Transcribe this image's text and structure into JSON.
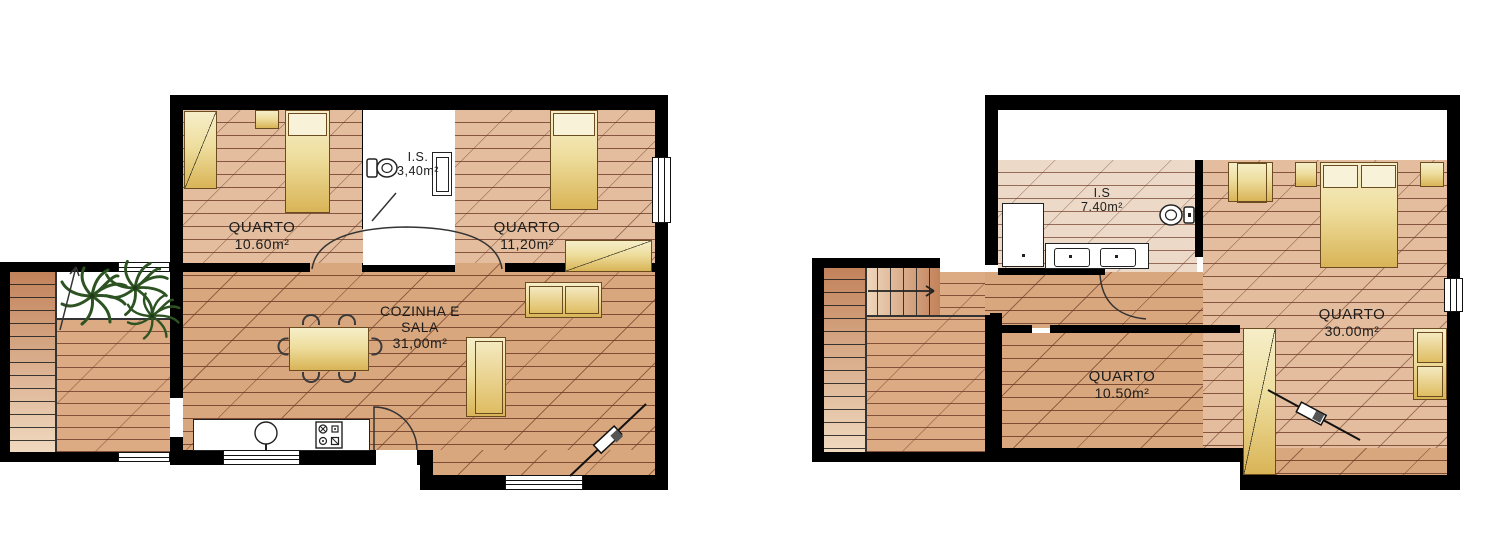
{
  "plans": {
    "ground_floor": {
      "rooms": {
        "bedroom1": {
          "name": "QUARTO",
          "area": "10.60m²"
        },
        "bathroom": {
          "name": "I.S.",
          "area": "3,40m²"
        },
        "bedroom2": {
          "name": "QUARTO",
          "area": "11,20m²"
        },
        "living": {
          "line1": "COZINHA E",
          "line2": "SALA",
          "area": "31,00m²"
        }
      }
    },
    "upper_floor": {
      "rooms": {
        "bathroom": {
          "name": "I.S",
          "area": "7.40m²"
        },
        "master": {
          "name": "QUARTO",
          "area": "30.00m²"
        },
        "bedroom2": {
          "name": "QUARTO",
          "area": "10.50m²"
        }
      }
    }
  },
  "palette": {
    "wall": "#000000",
    "floor_living": "#d9a77d",
    "floor_bedroom": "#e3bd9d",
    "floor_bath_upper": "#ecd9c7",
    "plank_line": "#6e3b28",
    "furniture_light": "#f6eec9",
    "furniture_gold": "#d9b457",
    "plant_green": "#2e5323",
    "stair_dark": "#c2825a",
    "stair_light": "#f0d9bf"
  }
}
